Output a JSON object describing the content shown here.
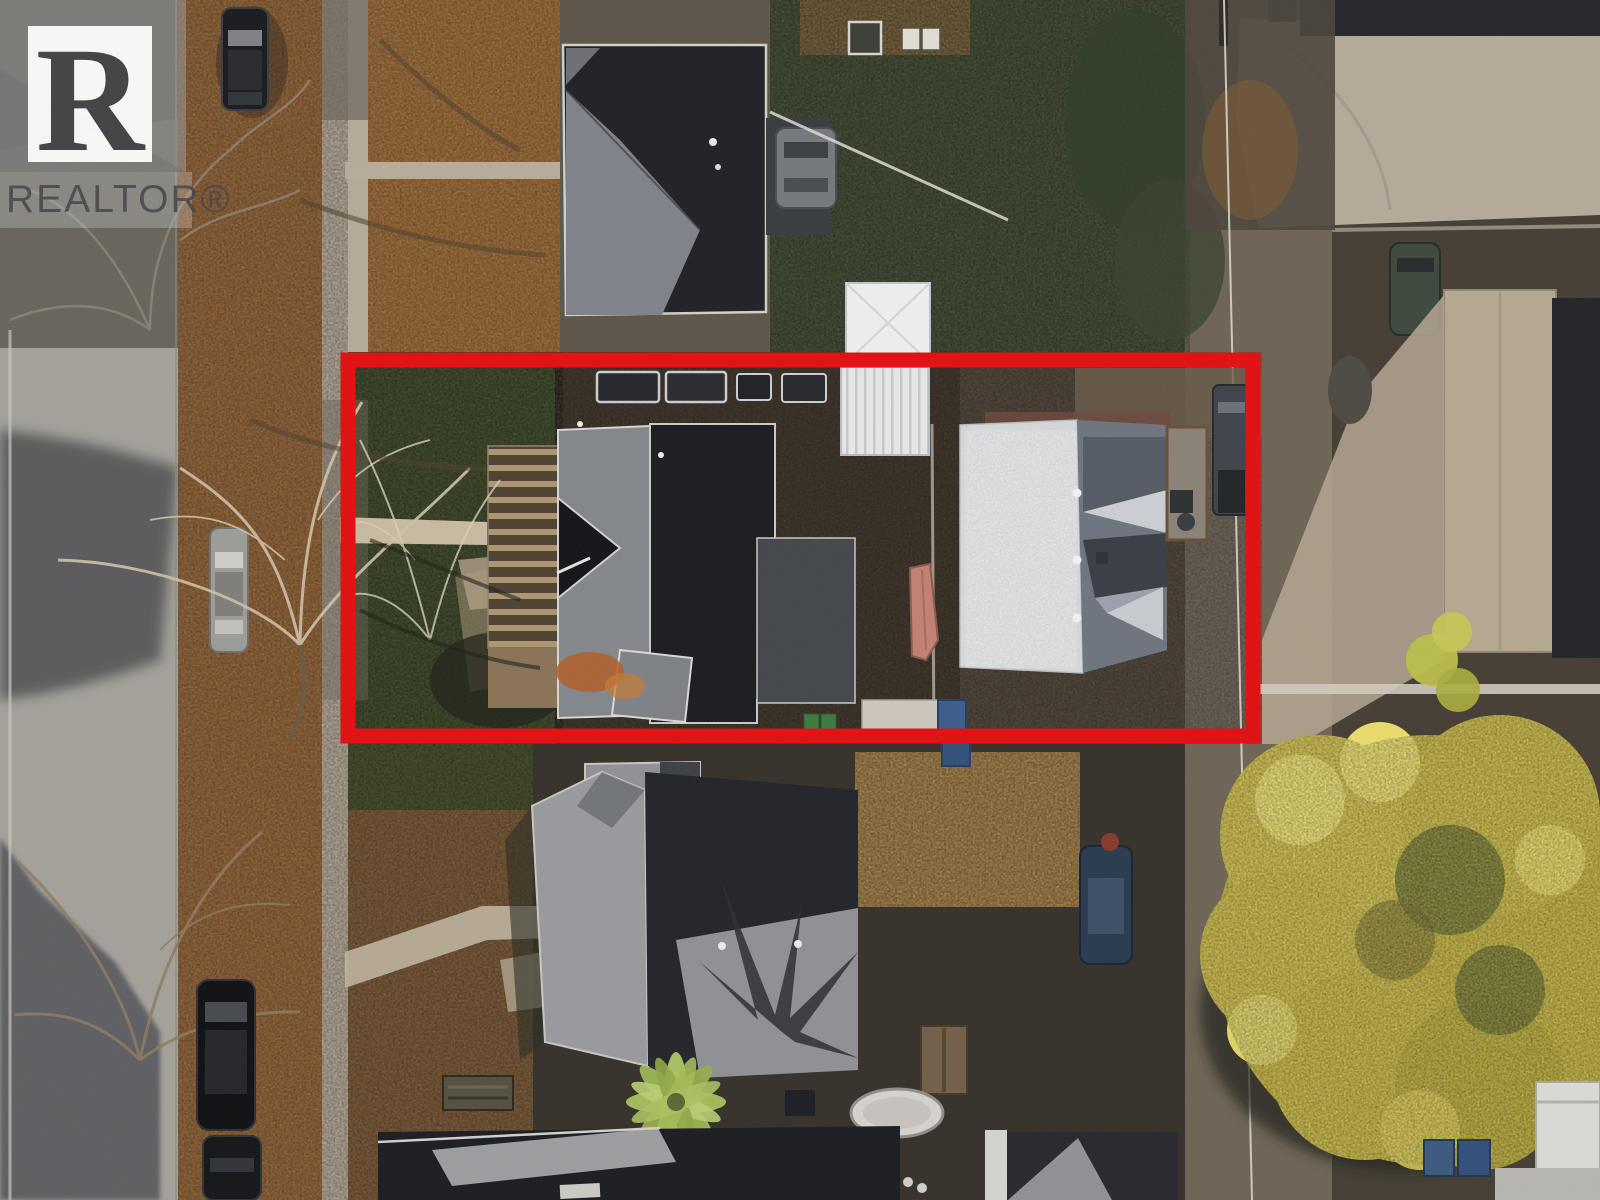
{
  "meta": {
    "type": "aerial-real-estate-photo",
    "description": "Overhead drone photo of a residential block in autumn; a red rectangle highlights one property containing two houses."
  },
  "watermark": {
    "brand": "REALTOR®",
    "logo_letter": "R",
    "square_color": "#9a9a9a",
    "inner_square_color": "#ffffff",
    "letter_color": "#3d3d40",
    "text_color": "#4a4a4d"
  },
  "annotation": {
    "name": "highlighted-lot",
    "color": "#e01414",
    "x": 348,
    "y": 360,
    "width": 905,
    "height": 376,
    "stroke_width": 15
  },
  "palette": {
    "street": "#a3a099",
    "street_shadow": "#54565a",
    "autumn_leaves": "#96683d",
    "lawn_dark": "#47513a",
    "dark_roof": "#212329",
    "mid_roof": "#83868b",
    "white_roof": "#d4d5d7",
    "white_structure": "#ececee",
    "golden_tree": "#c2b23e",
    "concrete": "#b2a999",
    "mulch": "#a8854f"
  },
  "scene": {
    "objects": [
      "street",
      "sidewalk",
      "boulevard with fallen leaves",
      "bare deciduous trees",
      "dark-roof house (top)",
      "highlighted lot with two houses",
      "wood stairs/deck",
      "white carport",
      "boat",
      "garbage bins",
      "back alley with utility wire",
      "garages",
      "parked cars",
      "golden autumn tree",
      "house with cross-gable roof (bottom)",
      "trampoline",
      "picnic table",
      "white trailer"
    ]
  }
}
